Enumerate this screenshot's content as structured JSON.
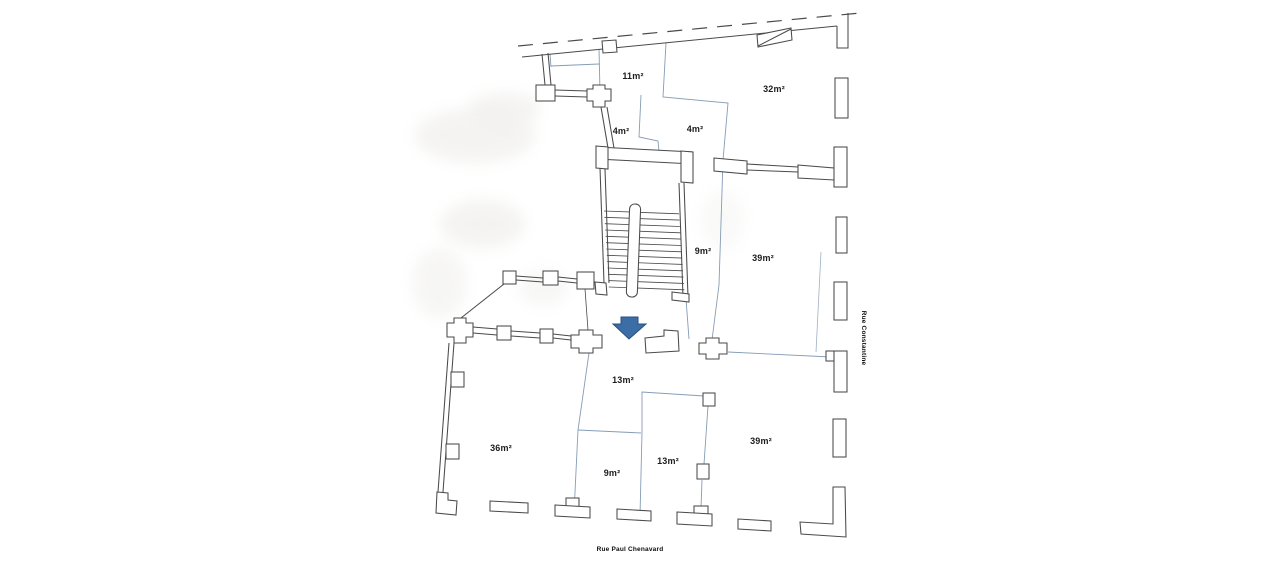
{
  "document": {
    "type": "scanned floor plan"
  },
  "colors": {
    "wall": "#4a4a4a",
    "divider": "#859cb5",
    "arrow_fill": "#3d6da6",
    "arrow_stroke": "#27507f",
    "label": "#1c1c1c",
    "street": "#0d0d0d"
  },
  "rooms": [
    {
      "label": "11m²",
      "x": 633,
      "y": 79
    },
    {
      "label": "32m²",
      "x": 774,
      "y": 92
    },
    {
      "label": "4m²",
      "x": 621,
      "y": 134
    },
    {
      "label": "4m²",
      "x": 695,
      "y": 132
    },
    {
      "label": "9m²",
      "x": 703,
      "y": 254
    },
    {
      "label": "39m²",
      "x": 763,
      "y": 261
    },
    {
      "label": "13m²",
      "x": 623,
      "y": 383
    },
    {
      "label": "36m²",
      "x": 501,
      "y": 451
    },
    {
      "label": "9m²",
      "x": 612,
      "y": 476
    },
    {
      "label": "13m²",
      "x": 668,
      "y": 464
    },
    {
      "label": "39m²",
      "x": 761,
      "y": 444
    }
  ],
  "streets": [
    {
      "name": "Rue Constantine",
      "x": 862,
      "y": 338
    },
    {
      "name": "Rue Paul Chenavard",
      "x": 630,
      "y": 551
    }
  ],
  "stairs": {
    "step_count": 13
  },
  "icons": {
    "entrance_arrow": "⬇"
  }
}
